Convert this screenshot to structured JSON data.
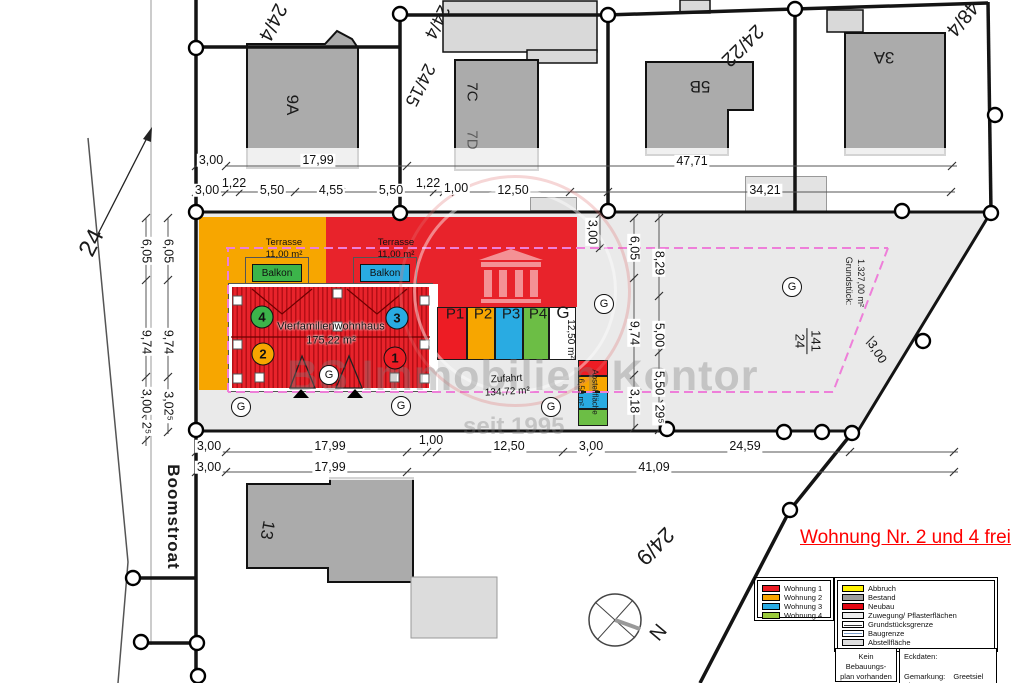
{
  "street": {
    "name": "Boomstroat",
    "left_parcel": "24"
  },
  "parcels": {
    "top_left": "24/4",
    "diag_a": "24/4",
    "diag_b": "24/15",
    "top_mid": "24/22",
    "top_right": "48/4",
    "bottom": "24/9",
    "main_fraction_top": "141",
    "main_fraction_bottom": "24"
  },
  "buildings": {
    "b1": "9A",
    "b2": "7C",
    "b3": "7D",
    "b4": "5B",
    "b5": "3A",
    "b6": "13"
  },
  "site": {
    "house_name": "Vierfamilienwohnhaus",
    "house_area": "175,22 m²",
    "terrace_label": "Terrasse",
    "terrace_area": "11,00 m²",
    "balcony_label": "Balkon",
    "unit_1": "1",
    "unit_2": "2",
    "unit_3": "3",
    "unit_4": "4",
    "garage_letter": "G",
    "parking": [
      "P1",
      "P2",
      "P3",
      "P4",
      "G"
    ],
    "parking_depth": "12,50 m²",
    "zufahrt_label": "Zufahrt",
    "zufahrt_area": "134,72 m²",
    "abstell_label": "Abstellfläche",
    "abstell_area": "16,50 m²",
    "grundstueck_label": "Grundstück:",
    "grundstueck_area": "1.327,00 m²",
    "north_letter": "N"
  },
  "dims": {
    "top_a": [
      "3,00",
      "17,99",
      "47,71"
    ],
    "top_b": [
      "3,00",
      "1,22",
      "5,50",
      "4,55",
      "5,50",
      "1,22",
      "1,00",
      "12,50",
      "34,21"
    ],
    "left_outer": [
      "6,05",
      "9,74",
      "3,00",
      "2⁵"
    ],
    "left_inner": [
      "6,05",
      "9,74",
      "3,02⁵"
    ],
    "mid_top": "3,00",
    "mid_a": [
      "6,05",
      "9,74",
      "3,18"
    ],
    "mid_b": [
      "8,29",
      "5,00",
      "5,50",
      "29⁵"
    ],
    "diag": "3,00",
    "bottom_a": [
      "3,00",
      "17,99",
      "1,00",
      "12,50",
      "3,00",
      "24,59"
    ],
    "bottom_b": [
      "3,00",
      "17,99",
      "41,09"
    ]
  },
  "watermark": {
    "line1": "BS Immobilien Kontor",
    "line2": "seit 1995"
  },
  "annotation": "Wohnung Nr. 2 und 4 frei",
  "legend_units": [
    {
      "label": "Wohnung 1",
      "color": "#ED1C24"
    },
    {
      "label": "Wohnung 2",
      "color": "#F7A600"
    },
    {
      "label": "Wohnung 3",
      "color": "#29ABE2"
    },
    {
      "label": "Wohnung 4",
      "color": "#9ACA3C"
    }
  ],
  "legend_items": [
    {
      "label": "Abbruch",
      "color": "#FFF200"
    },
    {
      "label": "Bestand",
      "color": "#9D9D9C"
    },
    {
      "label": "Neubau",
      "color": "#E30613"
    },
    {
      "label": "Zuwegung/ Pflasterflächen",
      "color": "#EDEDED"
    },
    {
      "label": "Grundstücksgrenze",
      "color": "#FFFFFF"
    },
    {
      "label": "Baugrenze",
      "color": "#9FB6D4"
    },
    {
      "label": "Abstellfläche",
      "color": "#DDDDDD"
    }
  ],
  "notes": {
    "left_line1": "Kein Bebauungs-",
    "left_line2": "plan vorhanden",
    "eckdaten": "Eckdaten:",
    "gemarkung_label": "Gemarkung:",
    "gemarkung_value": "Greetsiel",
    "flur_label": "Flur:",
    "flur_value": "10"
  },
  "colors": {
    "unit_red": "#ED1C24",
    "unit_orange": "#F7A600",
    "unit_blue": "#29ABE2",
    "unit_green": "#3CB44A",
    "p4_green": "#6CBE45",
    "white": "#FFFFFF",
    "baugrenze_magenta": "#EE7FD9",
    "parcel_gray": "#EAEAEA",
    "building_gray": "#ABABAB"
  }
}
